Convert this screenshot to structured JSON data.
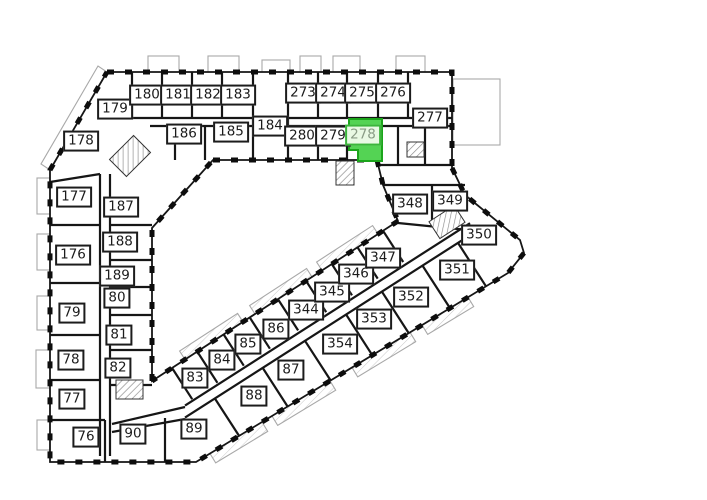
{
  "title": "Building floor plan with selected apartment",
  "colors": {
    "wall": "#161616",
    "thin_line": "#a8a8a8",
    "background": "#ffffff"
  },
  "selected_unit": {
    "id": "278",
    "fill": "#54d354",
    "stroke": "#1ba51b",
    "label_bg": "#e9f9e4",
    "label_border": "#3cb53c",
    "label_text": "#8a9c86"
  },
  "units": [
    {
      "id": "179",
      "x": 115,
      "y": 109
    },
    {
      "id": "178",
      "x": 81,
      "y": 141
    },
    {
      "id": "180",
      "x": 147,
      "y": 95
    },
    {
      "id": "181",
      "x": 178,
      "y": 95
    },
    {
      "id": "182",
      "x": 208,
      "y": 95
    },
    {
      "id": "183",
      "x": 238,
      "y": 95
    },
    {
      "id": "186",
      "x": 184,
      "y": 134
    },
    {
      "id": "185",
      "x": 231,
      "y": 132
    },
    {
      "id": "184",
      "x": 270,
      "y": 126
    },
    {
      "id": "273",
      "x": 303,
      "y": 93
    },
    {
      "id": "274",
      "x": 333,
      "y": 93
    },
    {
      "id": "275",
      "x": 362,
      "y": 93
    },
    {
      "id": "276",
      "x": 393,
      "y": 93
    },
    {
      "id": "277",
      "x": 430,
      "y": 118
    },
    {
      "id": "280",
      "x": 302,
      "y": 136
    },
    {
      "id": "279",
      "x": 333,
      "y": 136
    },
    {
      "id": "278",
      "x": 363,
      "y": 135,
      "highlighted": true
    },
    {
      "id": "177",
      "x": 74,
      "y": 197
    },
    {
      "id": "187",
      "x": 121,
      "y": 207
    },
    {
      "id": "176",
      "x": 73,
      "y": 255
    },
    {
      "id": "188",
      "x": 120,
      "y": 242
    },
    {
      "id": "189",
      "x": 117,
      "y": 276
    },
    {
      "id": "80",
      "x": 117,
      "y": 298
    },
    {
      "id": "79",
      "x": 72,
      "y": 313
    },
    {
      "id": "81",
      "x": 119,
      "y": 335
    },
    {
      "id": "78",
      "x": 71,
      "y": 360
    },
    {
      "id": "82",
      "x": 118,
      "y": 368
    },
    {
      "id": "77",
      "x": 72,
      "y": 399
    },
    {
      "id": "76",
      "x": 86,
      "y": 437
    },
    {
      "id": "90",
      "x": 133,
      "y": 434
    },
    {
      "id": "89",
      "x": 194,
      "y": 429
    },
    {
      "id": "83",
      "x": 195,
      "y": 378
    },
    {
      "id": "84",
      "x": 222,
      "y": 360
    },
    {
      "id": "85",
      "x": 248,
      "y": 344
    },
    {
      "id": "86",
      "x": 276,
      "y": 329
    },
    {
      "id": "88",
      "x": 254,
      "y": 396
    },
    {
      "id": "87",
      "x": 291,
      "y": 370
    },
    {
      "id": "344",
      "x": 306,
      "y": 310
    },
    {
      "id": "345",
      "x": 332,
      "y": 292
    },
    {
      "id": "346",
      "x": 356,
      "y": 274
    },
    {
      "id": "347",
      "x": 383,
      "y": 258
    },
    {
      "id": "354",
      "x": 340,
      "y": 344
    },
    {
      "id": "353",
      "x": 374,
      "y": 319
    },
    {
      "id": "352",
      "x": 411,
      "y": 297
    },
    {
      "id": "351",
      "x": 457,
      "y": 270
    },
    {
      "id": "350",
      "x": 479,
      "y": 235
    },
    {
      "id": "349",
      "x": 450,
      "y": 201
    },
    {
      "id": "348",
      "x": 410,
      "y": 204
    }
  ]
}
